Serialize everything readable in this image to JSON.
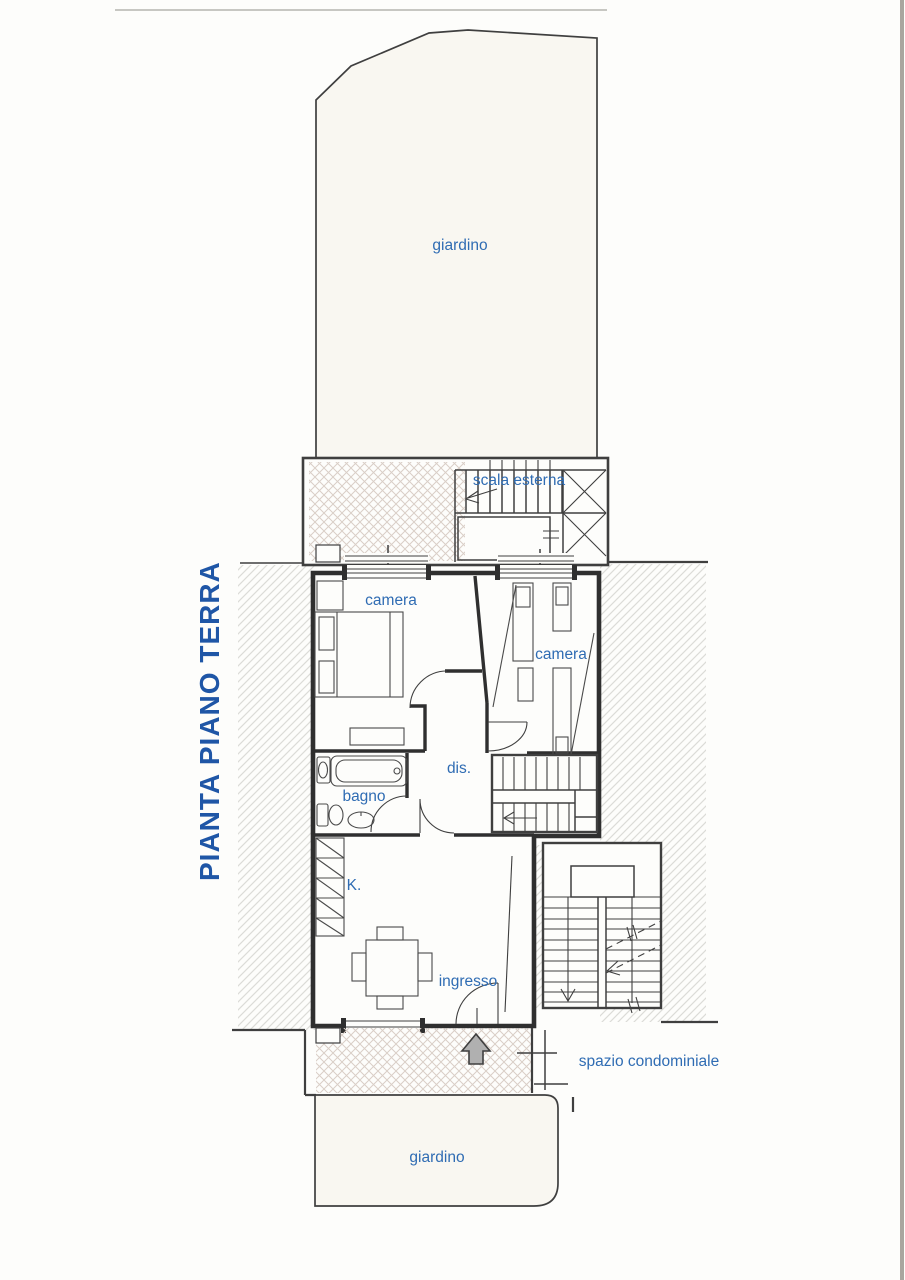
{
  "title": {
    "text": "PIANTA PIANO TERRA"
  },
  "labels": {
    "garden_top": "giardino",
    "external_stair": "scala esterna",
    "bedroom_left": "camera",
    "bedroom_right": "camera",
    "hallway": "dis.",
    "bathroom": "bagno",
    "kitchen": "K.",
    "entrance": "ingresso",
    "condo_space": "spazio condominiale",
    "garden_bottom": "giardino"
  },
  "colors": {
    "line": "#3f3f3f",
    "wall": "#2f2f2f",
    "label_blue": "#2f6cb3",
    "title_blue": "#1f56a6",
    "hatch_gray": "#dbdbd7",
    "crosshatch": "#d9cec7",
    "paper": "#fdfdfb",
    "garden": "#f9f7f1",
    "arrow_gray": "#b0b0b0"
  }
}
